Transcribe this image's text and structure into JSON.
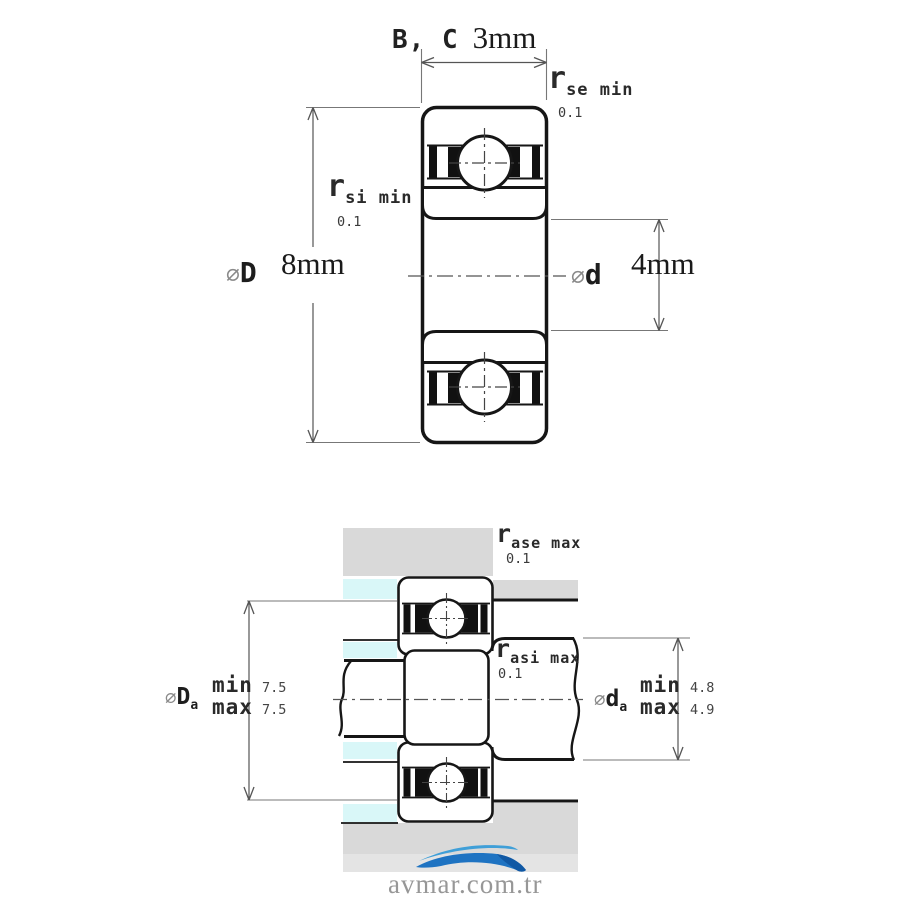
{
  "top_view": {
    "width_dim": {
      "label": "B, C",
      "value": "3mm"
    },
    "outer_diameter": {
      "symbol": "∅",
      "letter": "D",
      "value": "8mm"
    },
    "bore_diameter": {
      "symbol": "∅",
      "letter": "d",
      "value": "4mm"
    },
    "chamfer_outer": {
      "symbol": "r",
      "sub": "se min",
      "value": "0.1"
    },
    "chamfer_inner": {
      "symbol": "r",
      "sub": "si min",
      "value": "0.1"
    }
  },
  "mounting_view": {
    "fillet_housing": {
      "symbol": "r",
      "sub": "ase max",
      "value": "0.1"
    },
    "fillet_shaft": {
      "symbol": "r",
      "sub": "asi max",
      "value": "0.1"
    },
    "housing_shoulder_diameter": {
      "symbol": "∅",
      "letter": "D",
      "sub": "a",
      "min_label": "min",
      "min_value": "7.5",
      "max_label": "max",
      "max_value": "7.5"
    },
    "shaft_shoulder_diameter": {
      "symbol": "∅",
      "letter": "d",
      "sub": "a",
      "min_label": "min",
      "min_value": "4.8",
      "max_label": "max",
      "max_value": "4.9"
    }
  },
  "watermark": {
    "text": "avmar.com.tr"
  },
  "colors": {
    "line": "#161616",
    "dim_line": "#555555",
    "extension_line": "#777777",
    "housing_gray": "#d9d9d9",
    "groove_cyan": "#d9f7f8",
    "wave_blue_light": "#3f9fd8",
    "wave_blue": "#1e73c2",
    "wave_blue_dark": "#1058a4",
    "watermark_text_gray": "#979797"
  }
}
